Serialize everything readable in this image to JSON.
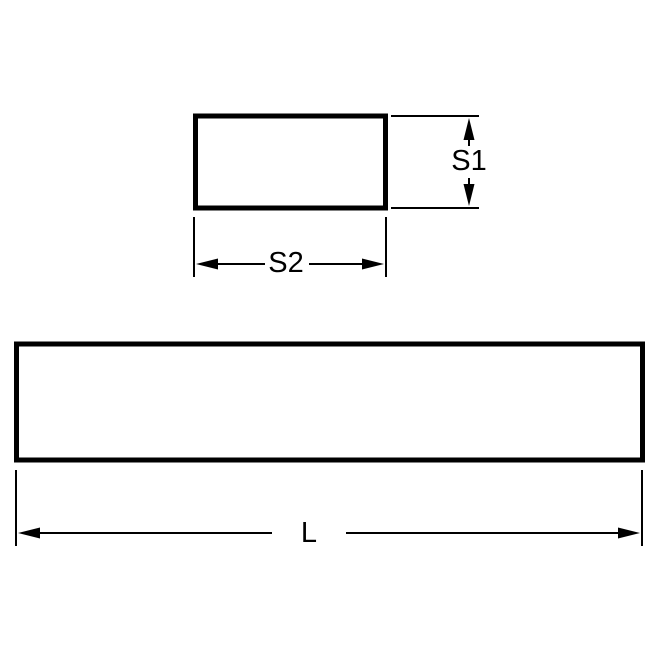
{
  "colors": {
    "line": "#000000",
    "background": "#ffffff"
  },
  "views": {
    "cross_section": {
      "height_label": "S1",
      "width_label": "S2"
    },
    "side": {
      "length_label": "L"
    }
  }
}
